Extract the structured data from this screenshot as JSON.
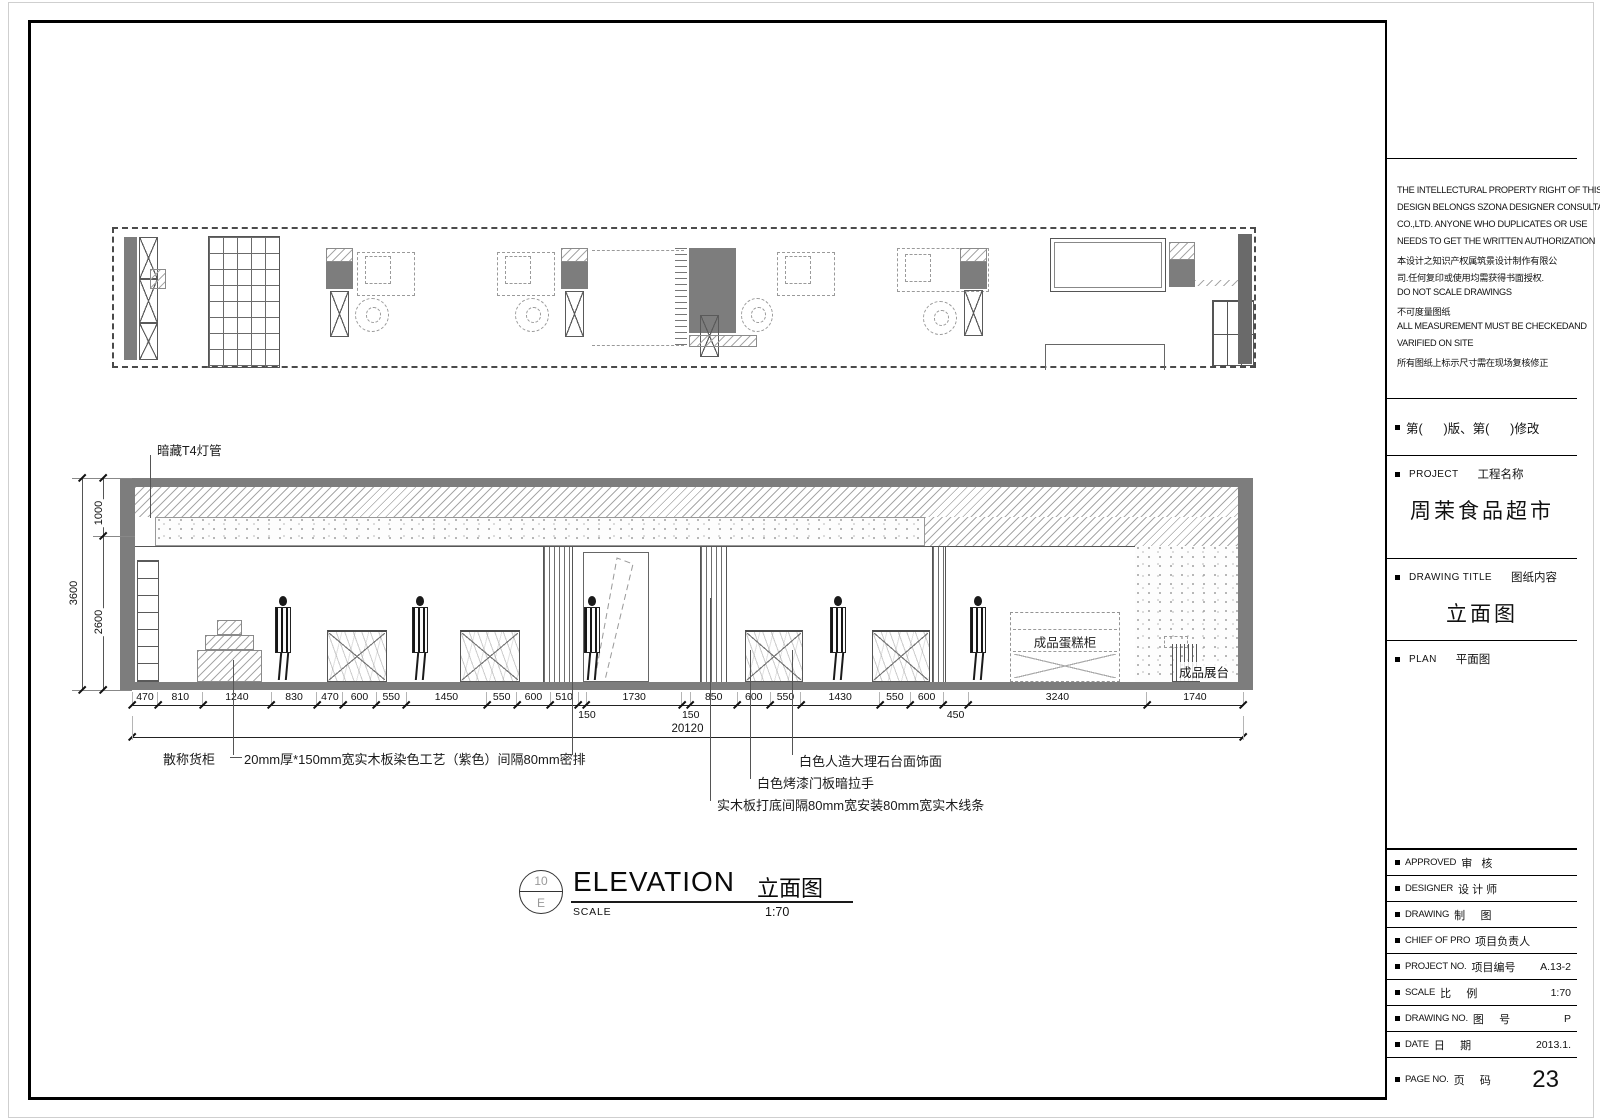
{
  "colors": {
    "wall_gray": "#7d7d7d",
    "line_dark": "#111111",
    "hatch_gray": "#a8a8a8"
  },
  "title_block": {
    "legal_lines": [
      "THE INTELLECTURAL PROPERTY RIGHT OF THIS",
      "DESIGN BELONGS SZONA DESIGNER CONSULTANT",
      "CO.,LTD. ANYONE WHO DUPLICATES OR USE",
      "NEEDS TO GET THE WRITTEN AUTHORIZATION",
      "本设计之知识产权属筑景设计制作有限公",
      "司.任何复印或使用均需获得书面授权.",
      "DO NOT SCALE DRAWINGS",
      "不可度量图纸",
      "ALL MEASUREMENT MUST BE CHECKEDAND",
      "VARIFIED ON SITE",
      "所有图纸上标示尺寸需在现场复核修正"
    ],
    "revision_row": "第(      )版、第(      )修改",
    "project_label_en": "PROJECT",
    "project_label_zh": "工程名称",
    "project_name": "周茉食品超市",
    "drawing_title_label_en": "DRAWING TITLE",
    "drawing_title_label_zh": "图纸内容",
    "drawing_title": "立面图",
    "plan_label_en": "PLAN",
    "plan_label_zh": "平面图",
    "rows": [
      {
        "en": "APPROVED",
        "zh": "审   核",
        "val": ""
      },
      {
        "en": "DESIGNER",
        "zh": "设 计 师",
        "val": ""
      },
      {
        "en": "DRAWING",
        "zh": "制     图",
        "val": ""
      },
      {
        "en": "CHIEF OF PRO",
        "zh": "项目负责人",
        "val": ""
      },
      {
        "en": "PROJECT NO.",
        "zh": "项目编号",
        "val": "A.13-2"
      },
      {
        "en": "SCALE",
        "zh": "比     例",
        "val": "1:70"
      },
      {
        "en": "DRAWING NO.",
        "zh": "图     号",
        "val": "P"
      },
      {
        "en": "DATE",
        "zh": "日     期",
        "val": "2013.1."
      },
      {
        "en": "PAGE NO.",
        "zh": "页     码",
        "val": "23"
      }
    ]
  },
  "elevation": {
    "callout_t4": "暗藏T4灯管",
    "label_bulk_cabinet": "散称货柜",
    "note_wood_panel": "20mm厚*150mm宽实木板染色工艺（紫色）间隔80mm密排",
    "note_marble": "白色人造大理石台面饰面",
    "note_door": "白色烤漆门板暗拉手",
    "note_wood_strip": "实木板打底间隔80mm宽安装80mm宽实木线条",
    "label_cake_cabinet": "成品蛋糕柜",
    "label_display_stand": "成品展台",
    "vdims": {
      "total": "3600",
      "upper": "1000",
      "lower": "2600"
    }
  },
  "dimensions": {
    "total": "20120",
    "segments": [
      {
        "mm": 470
      },
      {
        "mm": 810
      },
      {
        "mm": 1240
      },
      {
        "mm": 830
      },
      {
        "mm": 470
      },
      {
        "mm": 600
      },
      {
        "mm": 550
      },
      {
        "mm": 1450
      },
      {
        "mm": 550
      },
      {
        "mm": 600
      },
      {
        "mm": 510
      },
      {
        "mm": 150,
        "below": true
      },
      {
        "mm": 1730
      },
      {
        "mm": 150,
        "below": true
      },
      {
        "mm": 850
      },
      {
        "mm": 600
      },
      {
        "mm": 550
      },
      {
        "mm": 1430
      },
      {
        "mm": 550
      },
      {
        "mm": 600
      },
      {
        "mm": 450,
        "below": true
      },
      {
        "mm": 3240
      },
      {
        "mm": 1740
      }
    ]
  },
  "drawing_caption": {
    "bubble_number": "10",
    "bubble_letter": "E",
    "title_en": "ELEVATION",
    "title_zh": "立面图",
    "scale_label": "SCALE",
    "scale_value": "1:70"
  }
}
